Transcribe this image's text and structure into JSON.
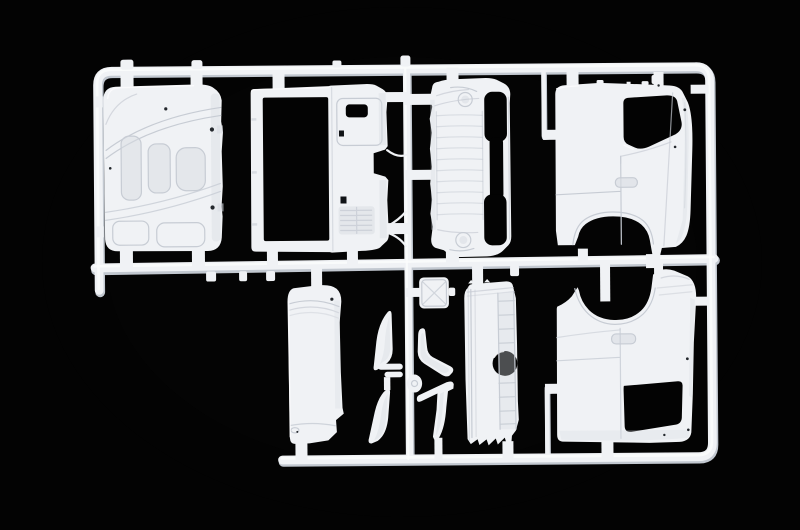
{
  "image": {
    "type": "photograph",
    "subject": "White plastic model-kit sprue (injection-molded parts frame) with truck cab body panels, photographed on a black background",
    "text_visible": ""
  },
  "colors": {
    "background": "#010101",
    "plastic_base": "#f0f2f5",
    "plastic_bright": "#fbfcfd",
    "plastic_shade": "#d8dce2",
    "plastic_shadow": "#c2c8d0",
    "crease": "#c7ccd4",
    "hole": "#030303"
  },
  "parts": [
    {
      "id": "cab-roof-panel",
      "label": "cab roof panel with molded recesses"
    },
    {
      "id": "cab-rear-wall",
      "label": "cab rear wall with large opening and vent"
    },
    {
      "id": "cab-front-panel",
      "label": "cab front panel with windshield opening and headlamps"
    },
    {
      "id": "cab-side-panel-upper",
      "label": "cab side panel with door window and wheel arch"
    },
    {
      "id": "cab-side-panel-lower",
      "label": "opposite cab side panel with door window and wheel arch"
    },
    {
      "id": "side-skirt-panel",
      "label": "smooth side skirt panel"
    },
    {
      "id": "grille-step-panel",
      "label": "grille/step panel with circular hole and ladder rungs"
    },
    {
      "id": "roof-hatch",
      "label": "small hatch part with X ribs"
    },
    {
      "id": "visor-blades",
      "label": "two curved blade parts"
    },
    {
      "id": "mirror-arms",
      "label": "two bent mirror-arm parts"
    }
  ]
}
